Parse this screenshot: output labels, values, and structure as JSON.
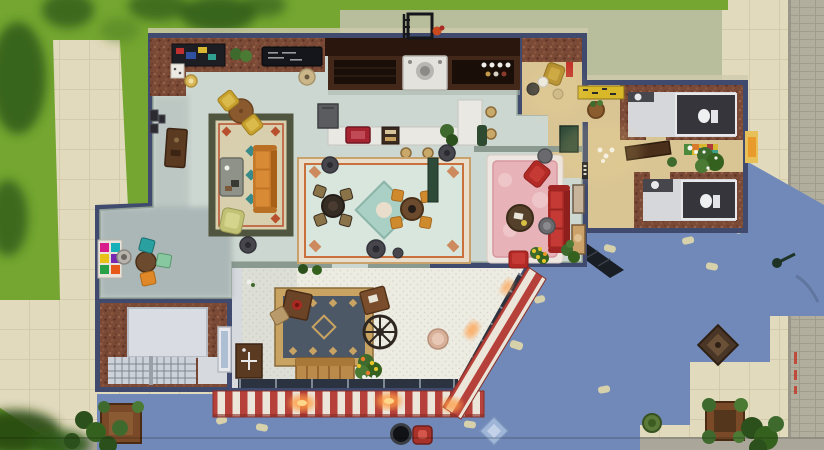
{
  "scene": {
    "title": "Life-sim build-mode screenshot: top-down view of a Central Perk style corner cafe",
    "view": "top-down floor plan, daytime, building shadow cast to the south-east",
    "visible_text": []
  },
  "palette": {
    "grass": "#74a631",
    "grass_dark": "#36621a",
    "path": "#e2dabd",
    "path_line": "#d3cbaa",
    "sage": "#b8bd9b",
    "street": "#b2ae9e",
    "street_line": "#a19d8d",
    "curb": "#aaa69a",
    "shadow": "#7189b8",
    "leaf_light": "#d6d0ab",
    "wall": "#3f4a6e",
    "brick": "#7b4a36",
    "cafe_floor": "#cdd7d1",
    "porch_tile": "#edece3",
    "porch_dot": "#d9d5c6",
    "wood_floor": "#d9c494",
    "bath_floor": "#d6d7db",
    "stall": "#35353b",
    "marble": "#eae8e2",
    "counter_wood": "#432718",
    "counter_back": "#2a160d",
    "register": "#a62430",
    "awning_red": "#b5413a",
    "awning_white": "#ece5d9",
    "window_dark": "#2b3340",
    "glow": "#ff9d45",
    "sofa_orange": "#c97a2a",
    "sofa_red": "#b22a26",
    "rug_pink": "#e7b3b8",
    "rug_left_field": "#d8cfae",
    "rug_center_field": "#d8e6dd",
    "rug_entry_field": "#4d5866",
    "rug_entry_border": "#c9a362",
    "stool": "#c9a96a",
    "gold": "#c8a12e",
    "plant": "#3f6a2e",
    "plant_dark": "#2c501b",
    "pouf": "#46464c",
    "toilet": "#eef0f2",
    "doormat": "#d8b828",
    "hydrant": "#a8322a",
    "tile_blue": "#9fb6d8",
    "medallion": "#4a3626",
    "lamp": "#1e3326"
  },
  "regions": [
    {
      "id": "lawn",
      "label": "Grass lawn with tree shadows"
    },
    {
      "id": "sidewalk",
      "label": "Beige tiled sidewalk"
    },
    {
      "id": "street",
      "label": "Grey brick street (right edge)"
    },
    {
      "id": "backyard",
      "label": "Sage concrete back yard"
    },
    {
      "id": "building-shadow",
      "label": "Blue building shadow with leaf light spots"
    },
    {
      "id": "cafe-main",
      "label": "Main cafe hall"
    },
    {
      "id": "coffee-bar",
      "label": "Back coffee bar with espresso machines"
    },
    {
      "id": "service-counter",
      "label": "White L-shaped service counter"
    },
    {
      "id": "left-lounge",
      "label": "West lounge with orange sofa"
    },
    {
      "id": "center-lounge",
      "label": "Central rug with two dining sets"
    },
    {
      "id": "pink-lounge",
      "label": "Pink lounge with red sofas"
    },
    {
      "id": "art-nook",
      "label": "Art nook with colorful chairs"
    },
    {
      "id": "entry-porch",
      "label": "Hex-tiled entry porch"
    },
    {
      "id": "vestibule",
      "label": "Wood-floored vestibule"
    },
    {
      "id": "hallway",
      "label": "Annex hallway"
    },
    {
      "id": "bathroom-north",
      "label": "North bathroom"
    },
    {
      "id": "bathroom-south",
      "label": "South bathroom"
    },
    {
      "id": "skylight-room",
      "label": "Brick room with skylight and lattice windows"
    }
  ],
  "objects": [
    {
      "id": "espresso-machine",
      "label": "Espresso machine"
    },
    {
      "id": "cash-register",
      "label": "Red cash register"
    },
    {
      "id": "pastry-display",
      "label": "Pastry display case"
    },
    {
      "id": "mini-fridge",
      "label": "Grey mini fridge"
    },
    {
      "id": "bar-stool",
      "label": "Tan bar stool"
    },
    {
      "id": "menu-board",
      "label": "Chalk menu board"
    },
    {
      "id": "abstract-painting",
      "label": "Colorful wall painting"
    },
    {
      "id": "orange-sofa",
      "label": "Orange sofa"
    },
    {
      "id": "red-sofa",
      "label": "Red sofa"
    },
    {
      "id": "coffee-table",
      "label": "Grey coffee table"
    },
    {
      "id": "wagon-wheel",
      "label": "Wagon wheel decoration"
    },
    {
      "id": "wooden-bench",
      "label": "Wooden bench"
    },
    {
      "id": "striped-awning",
      "label": "Red and white striped awning"
    },
    {
      "id": "fire-escape",
      "label": "Fire escape ladder"
    },
    {
      "id": "street-lamp",
      "label": "Green street lamp"
    },
    {
      "id": "fire-hydrant",
      "label": "Red fire hydrant"
    },
    {
      "id": "round-trash-can",
      "label": "Round black trash can"
    },
    {
      "id": "toilet",
      "label": "Toilet in dark stall"
    },
    {
      "id": "doormat",
      "label": "Yellow doormat"
    },
    {
      "id": "planter",
      "label": "Wooden planter box with shrubs"
    }
  ]
}
